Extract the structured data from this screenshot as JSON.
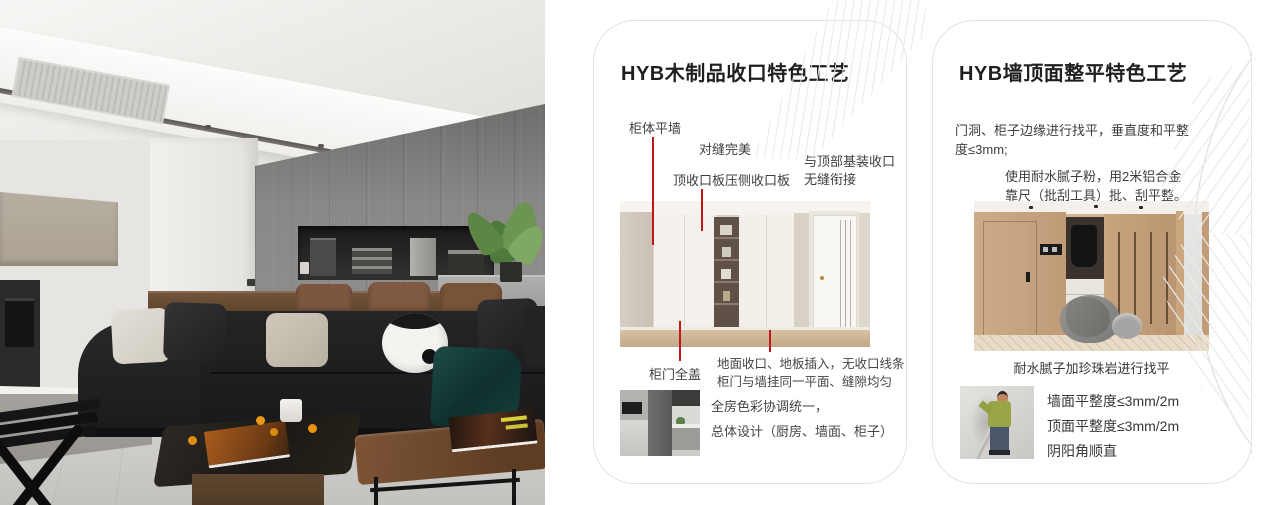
{
  "colors": {
    "accent_red": "#c1151a",
    "card_border": "#e2e2e2",
    "title_color": "#1f1f1f",
    "body_color": "#3f3f3f",
    "pattern_line": "#e9e9e9"
  },
  "card1": {
    "title": "HYB木制品收口特色工艺",
    "callout_cabinet_wall": "柜体平墙",
    "callout_seam": "对缝完美",
    "callout_top_board": "顶收口板压侧收口板",
    "callout_top_join_line1": "与顶部基装收口",
    "callout_top_join_line2": "无缝衔接",
    "callout_full_cover": "柜门全盖",
    "note_line1": "地面收口、地板插入，无收口线条",
    "note_line2": "柜门与墙挂同一平面、缝隙均匀",
    "summary_line1": "全房色彩协调统一，",
    "summary_line2": "总体设计（厨房、墙面、柜子）"
  },
  "card2": {
    "title": "HYB墙顶面整平特色工艺",
    "para1_line1": "门洞、柜子边缘进行找平，垂直度和平整",
    "para1_line2": "度≤3mm;",
    "para2_line1": "使用耐水腻子粉，用2米铝合金",
    "para2_line2": "靠尺（批刮工具）批、刮平整。",
    "caption": "耐水腻子加珍珠岩进行找平",
    "spec_line1": "墙面平整度≤3mm/2m",
    "spec_line2": "顶面平整度≤3mm/2m",
    "spec_line3": "阴阳角顺直"
  }
}
